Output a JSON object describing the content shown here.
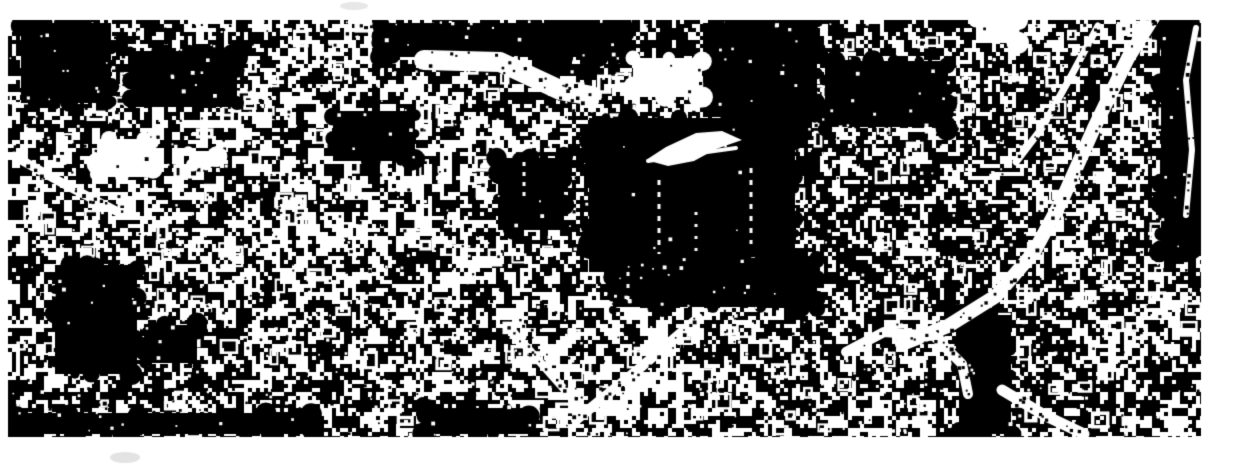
{
  "meta": {
    "width": 1240,
    "height": 466,
    "description": "High-contrast black-and-white binarized aerial satellite image of a dense urban area; white building blobs and roads on black ground, centered on a page with white margins"
  },
  "palette": {
    "foreground": "#000000",
    "background": "#ffffff",
    "margin": "#ffffff",
    "smudge": "#b9b9b9"
  },
  "image": {
    "bounds": {
      "x": 8,
      "y": 20,
      "width": 1193,
      "height": 417
    },
    "texture": {
      "seed": 1337,
      "coarse_cell": 9,
      "fine_cell": 4,
      "p_coarse_white": 0.48,
      "p_white_hi": 0.8,
      "p_white_lo": 0.16,
      "ring_count": 520,
      "speck_count": 1500
    },
    "density_regions": [
      {
        "name": "top-left-dark-zone",
        "x": 0,
        "y": 20,
        "w": 250,
        "h": 110,
        "m": 0.72
      },
      {
        "name": "top-center-dark-band",
        "x": 370,
        "y": 20,
        "w": 450,
        "h": 55,
        "m": 0.6
      },
      {
        "name": "mid-left-bright-zone",
        "x": 120,
        "y": 120,
        "w": 300,
        "h": 130,
        "m": 1.12
      },
      {
        "name": "center-dark-surround",
        "x": 560,
        "y": 90,
        "w": 270,
        "h": 210,
        "m": 0.72
      },
      {
        "name": "right-of-center-dark",
        "x": 820,
        "y": 20,
        "w": 210,
        "h": 290,
        "m": 0.75
      },
      {
        "name": "right-road-zone",
        "x": 1020,
        "y": 20,
        "w": 150,
        "h": 270,
        "m": 0.9
      },
      {
        "name": "bottom-center-bright",
        "x": 540,
        "y": 300,
        "w": 270,
        "h": 120,
        "m": 1.2
      },
      {
        "name": "bottom-mid-right",
        "x": 700,
        "y": 300,
        "w": 150,
        "h": 137,
        "m": 0.85
      },
      {
        "name": "bottom-right-dark",
        "x": 950,
        "y": 295,
        "w": 100,
        "h": 145,
        "m": 0.72
      },
      {
        "name": "bottom-edge-darker",
        "x": 0,
        "y": 385,
        "w": 430,
        "h": 52,
        "m": 0.8
      }
    ],
    "dark_regions": [
      {
        "name": "top-left-blob-a",
        "x": 18,
        "y": 20,
        "w": 96,
        "h": 86,
        "specks": 0.5
      },
      {
        "name": "top-left-blob-b",
        "x": 128,
        "y": 48,
        "w": 112,
        "h": 62,
        "specks": 0.5
      },
      {
        "name": "top-center-band",
        "x": 378,
        "y": 20,
        "w": 250,
        "h": 40,
        "specks": 0.7
      },
      {
        "name": "top-center-band-b",
        "x": 700,
        "y": 20,
        "w": 120,
        "h": 100,
        "specks": 0.5
      },
      {
        "name": "central-large-block",
        "x": 586,
        "y": 115,
        "w": 212,
        "h": 160,
        "specks": 0.12
      },
      {
        "name": "block-west-annex",
        "x": 495,
        "y": 155,
        "w": 72,
        "h": 78,
        "specks": 0.3
      },
      {
        "name": "mid-left-patch",
        "x": 330,
        "y": 108,
        "w": 88,
        "h": 56,
        "specks": 0.6
      },
      {
        "name": "right-of-center-patch",
        "x": 822,
        "y": 58,
        "w": 128,
        "h": 72,
        "specks": 0.6
      },
      {
        "name": "below-block-patch",
        "x": 610,
        "y": 255,
        "w": 210,
        "h": 55,
        "specks": 0.8
      },
      {
        "name": "bottom-left-mass",
        "x": 52,
        "y": 262,
        "w": 88,
        "h": 115,
        "specks": 0.35
      },
      {
        "name": "bottom-left-blob-b",
        "x": 142,
        "y": 322,
        "w": 58,
        "h": 44,
        "specks": 0.6
      },
      {
        "name": "bottom-right-band",
        "x": 956,
        "y": 312,
        "w": 58,
        "h": 125,
        "specks": 0.25
      },
      {
        "name": "bottom-edge-left-band",
        "x": 14,
        "y": 410,
        "w": 300,
        "h": 27,
        "specks": 0.55
      },
      {
        "name": "bottom-center-edge",
        "x": 420,
        "y": 405,
        "w": 112,
        "h": 32,
        "specks": 0.5
      },
      {
        "name": "far-right-band",
        "x": 1158,
        "y": 20,
        "w": 46,
        "h": 235,
        "specks": 0.4
      }
    ],
    "bright_regions": [
      {
        "name": "left-white-patch",
        "x": 94,
        "y": 136,
        "w": 62,
        "h": 44,
        "specks": 0.35
      },
      {
        "name": "left-top-white-blob",
        "x": 186,
        "y": 148,
        "w": 34,
        "h": 20,
        "specks": 0.2
      },
      {
        "name": "center-white-blob",
        "x": 630,
        "y": 55,
        "w": 75,
        "h": 45,
        "specks": 0.45
      },
      {
        "name": "top-right-white-blob",
        "x": 973,
        "y": 16,
        "w": 48,
        "h": 30,
        "specks": 0.4
      }
    ],
    "roads": [
      {
        "name": "upper-diagonal-white-streak",
        "width": 20,
        "specks": 26,
        "points": [
          [
            424,
            60
          ],
          [
            500,
            62
          ],
          [
            560,
            90
          ],
          [
            592,
            96
          ]
        ]
      },
      {
        "name": "right-main-curved-road",
        "width": 14,
        "specks": 45,
        "points": [
          [
            1154,
            16
          ],
          [
            1128,
            58
          ],
          [
            1094,
            128
          ],
          [
            1062,
            200
          ],
          [
            1034,
            252
          ],
          [
            996,
            296
          ],
          [
            948,
            326
          ],
          [
            902,
            344
          ]
        ]
      },
      {
        "name": "right-parallel-road",
        "width": 7,
        "specks": 16,
        "points": [
          [
            1098,
            26
          ],
          [
            1070,
            78
          ],
          [
            1042,
            128
          ],
          [
            1016,
            162
          ]
        ]
      },
      {
        "name": "far-right-edge-road",
        "width": 6,
        "specks": 10,
        "points": [
          [
            1196,
            28
          ],
          [
            1186,
            80
          ],
          [
            1192,
            150
          ],
          [
            1186,
            215
          ]
        ]
      },
      {
        "name": "bottom-right-swirl-road",
        "width": 10,
        "specks": 18,
        "points": [
          [
            846,
            352
          ],
          [
            884,
            332
          ],
          [
            934,
            336
          ],
          [
            962,
            364
          ],
          [
            968,
            394
          ]
        ]
      },
      {
        "name": "bottom-right-diagonal-road",
        "width": 11,
        "specks": 12,
        "points": [
          [
            1002,
            390
          ],
          [
            1046,
            416
          ],
          [
            1084,
            434
          ]
        ]
      },
      {
        "name": "left-diagonal-streak",
        "width": 9,
        "specks": 14,
        "points": [
          [
            14,
            156
          ],
          [
            64,
            184
          ],
          [
            118,
            212
          ]
        ]
      },
      {
        "name": "aircraft-tail-streak",
        "width": 4,
        "specks": 0,
        "points": [
          [
            648,
            161
          ],
          [
            700,
            153
          ],
          [
            736,
            148
          ]
        ]
      },
      {
        "name": "bottom-center-diagonal-up",
        "width": 10,
        "specks": 22,
        "points": [
          [
            576,
            420
          ],
          [
            640,
            368
          ],
          [
            698,
            318
          ]
        ]
      },
      {
        "name": "bottom-center-diagonal-down",
        "width": 8,
        "specks": 14,
        "points": [
          [
            508,
            326
          ],
          [
            572,
            398
          ]
        ]
      }
    ],
    "polygons": [
      {
        "name": "white-streak-aircraft-shape",
        "color": "#ffffff",
        "points": [
          [
            646,
            160
          ],
          [
            666,
            147
          ],
          [
            696,
            133
          ],
          [
            722,
            131
          ],
          [
            742,
            140
          ],
          [
            716,
            149
          ],
          [
            694,
            161
          ],
          [
            668,
            166
          ]
        ]
      }
    ],
    "dashed_lines": [
      {
        "name": "block-dashes-1",
        "x": 659,
        "y1": 180,
        "y2": 254,
        "dash": 5,
        "gap": 7,
        "w": 3
      },
      {
        "name": "block-dashes-2",
        "x": 751,
        "y1": 168,
        "y2": 244,
        "dash": 5,
        "gap": 7,
        "w": 3
      },
      {
        "name": "block-dashes-3",
        "x": 524,
        "y1": 162,
        "y2": 202,
        "dash": 4,
        "gap": 6,
        "w": 3
      },
      {
        "name": "block-dashes-4",
        "x": 628,
        "y1": 272,
        "y2": 332,
        "dash": 4,
        "gap": 8,
        "w": 3
      },
      {
        "name": "block-dashes-5",
        "x": 696,
        "y1": 212,
        "y2": 252,
        "dash": 3,
        "gap": 9,
        "w": 3
      }
    ],
    "smudges": [
      {
        "name": "faint-top-margin-smudge",
        "x": 340,
        "y": 2,
        "w": 28,
        "h": 8,
        "color": "#b9b9b9",
        "opacity": 0.35
      },
      {
        "name": "faint-bottom-margin-smudge",
        "x": 110,
        "y": 452,
        "w": 30,
        "h": 11,
        "color": "#b9b9b9",
        "opacity": 0.4
      }
    ]
  }
}
